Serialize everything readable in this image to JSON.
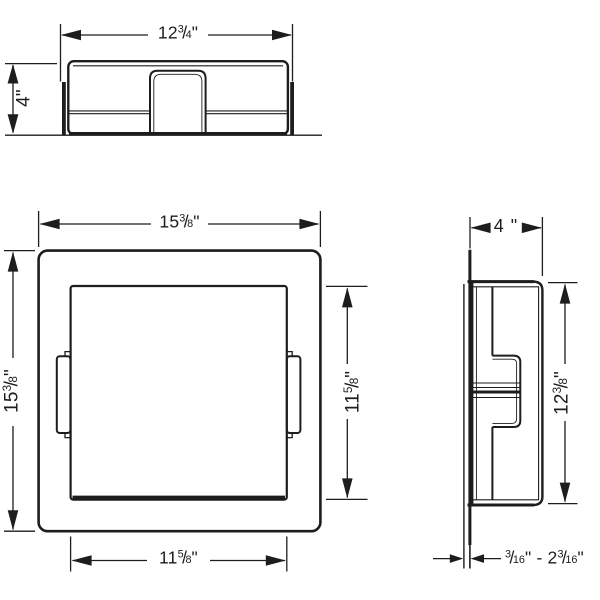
{
  "meta": {
    "kind": "technical installation drawing",
    "subject": "square recessed wall niche with mounting flange, shown in top, front and side views"
  },
  "colors": {
    "background": "#ffffff",
    "ink": "#1d1d1b"
  },
  "dimensions": {
    "top_width": {
      "text": "12 3/4\"",
      "parts": [
        {
          "t": "12"
        },
        {
          "n": "3",
          "d": "4"
        },
        {
          "t": "\""
        }
      ]
    },
    "top_depth": {
      "text": "4\"",
      "parts": [
        {
          "t": "4\""
        }
      ]
    },
    "front_outer_width": {
      "text": "15 3/8\"",
      "parts": [
        {
          "t": "15"
        },
        {
          "n": "3",
          "d": "8"
        },
        {
          "t": "\""
        }
      ]
    },
    "front_outer_height": {
      "text": "15 3/8\"",
      "parts": [
        {
          "t": "15"
        },
        {
          "n": "3",
          "d": "8"
        },
        {
          "t": "\""
        }
      ]
    },
    "front_inner_height": {
      "text": "11 5/8\"",
      "parts": [
        {
          "t": "11"
        },
        {
          "n": "5",
          "d": "8"
        },
        {
          "t": "\""
        }
      ]
    },
    "front_inner_width": {
      "text": "11 5/8\"",
      "parts": [
        {
          "t": "11"
        },
        {
          "n": "5",
          "d": "8"
        },
        {
          "t": "\""
        }
      ]
    },
    "side_depth": {
      "text": "4 \"",
      "parts": [
        {
          "t": "4 \""
        }
      ]
    },
    "side_inner_height": {
      "text": "12 3/8\"",
      "parts": [
        {
          "t": "12"
        },
        {
          "n": "3",
          "d": "8"
        },
        {
          "t": "\""
        }
      ]
    },
    "tile_thickness_range": {
      "text": "3/16\" - 2 3/16\"",
      "parts": [
        {
          "n": "3",
          "d": "16"
        },
        {
          "t": "\" - 2"
        },
        {
          "n": "3",
          "d": "16"
        },
        {
          "t": "\""
        }
      ]
    }
  }
}
